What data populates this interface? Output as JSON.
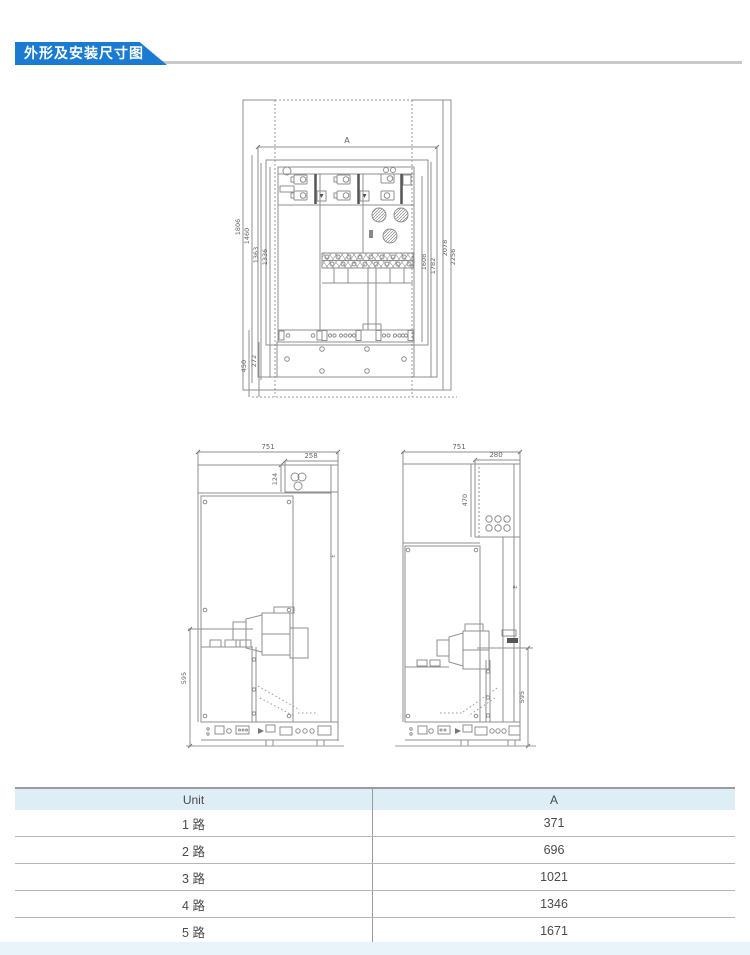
{
  "header": {
    "title": "外形及安装尺寸图"
  },
  "front_view": {
    "width_label": "A",
    "left_dims": [
      "1806",
      "1460",
      "1363",
      "1336"
    ],
    "right_dims": [
      "1608",
      "1782",
      "2078",
      "2256"
    ],
    "plinth_dims": [
      "450",
      "272"
    ]
  },
  "side_view_left": {
    "top_width": "751",
    "top_right_width": "258",
    "top_right_height": "124",
    "lower_height": "595",
    "depth_label": "E"
  },
  "side_view_right": {
    "top_width": "751",
    "top_right_width": "280",
    "upper_height": "470",
    "lower_height": "595",
    "depth_label": "E"
  },
  "table": {
    "headers": [
      "Unit",
      "A"
    ],
    "rows": [
      {
        "unit": "1 路",
        "a": "371"
      },
      {
        "unit": "2 路",
        "a": "696"
      },
      {
        "unit": "3 路",
        "a": "1021"
      },
      {
        "unit": "4 路",
        "a": "1346"
      },
      {
        "unit": "5 路",
        "a": "1671"
      }
    ]
  },
  "colors": {
    "banner_blue": "#1a7bd0",
    "table_header_bg": "#ddeef7"
  }
}
